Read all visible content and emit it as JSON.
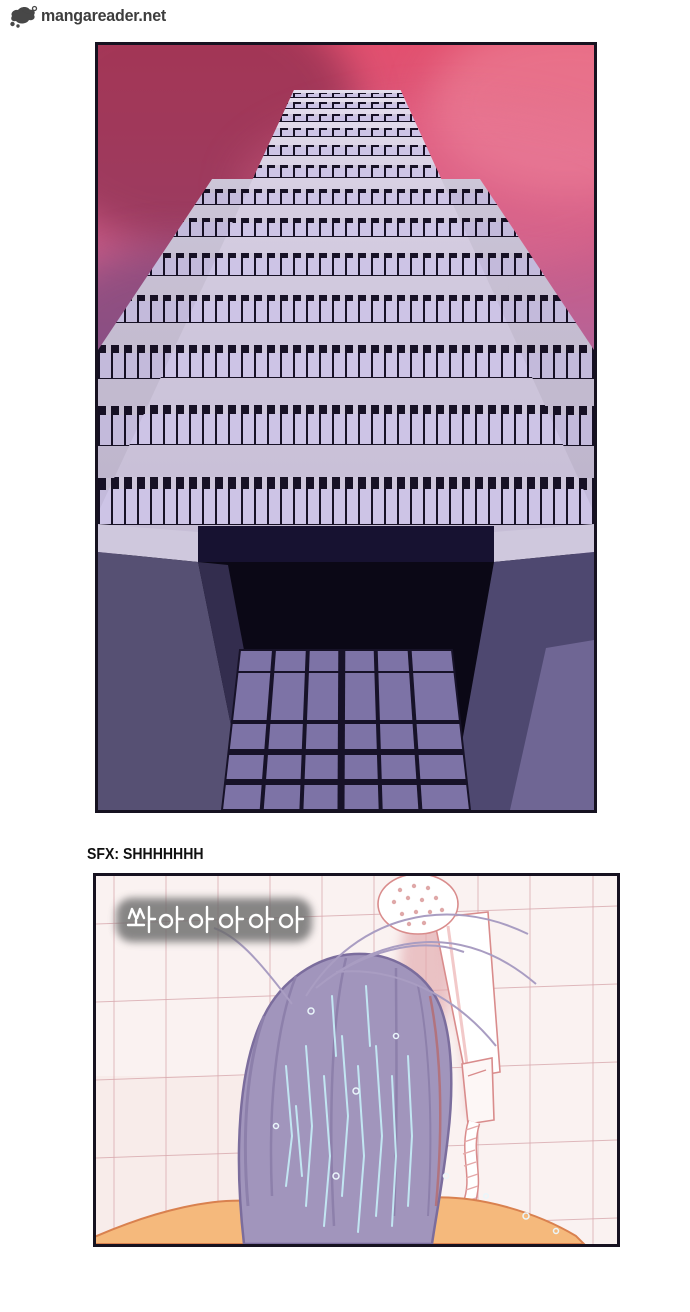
{
  "logo": {
    "text": "mangareader.net",
    "icon": "mascot-icon",
    "color": "#3d3d3d"
  },
  "captions": {
    "sfx_label": "SFX: SHHHHHHH"
  },
  "panel_building": {
    "subject": "skyscraper seen from below against pink-purple sky",
    "colors": {
      "sky_top": "#e2506f",
      "sky_bottom": "#8a79ad",
      "facade": "#cfc7dc",
      "window_pane": "#cdc4e6",
      "window_dark": "#171126",
      "entrance_wall": "#565073",
      "entrance_glass": "#7d73a6",
      "entrance_void": "#0b0816",
      "ledge": "#cfc8dd"
    }
  },
  "panel_shower": {
    "sfx_text": "쏴아아아아아",
    "subject": "person with long hair under shower against pink tiled wall",
    "colors": {
      "tile": "#faf2f1",
      "grout": "#dcaeb2",
      "skin": "#f5b97c",
      "skin_shadow": "#e8955c",
      "hair": "#a195bc",
      "hair_outline": "#7b6d9d",
      "water_streak": "#c2e6f2",
      "shower_white": "#ffffff",
      "shower_outline": "#d98c8c",
      "wall_shadow": "#e2a9ad"
    }
  }
}
